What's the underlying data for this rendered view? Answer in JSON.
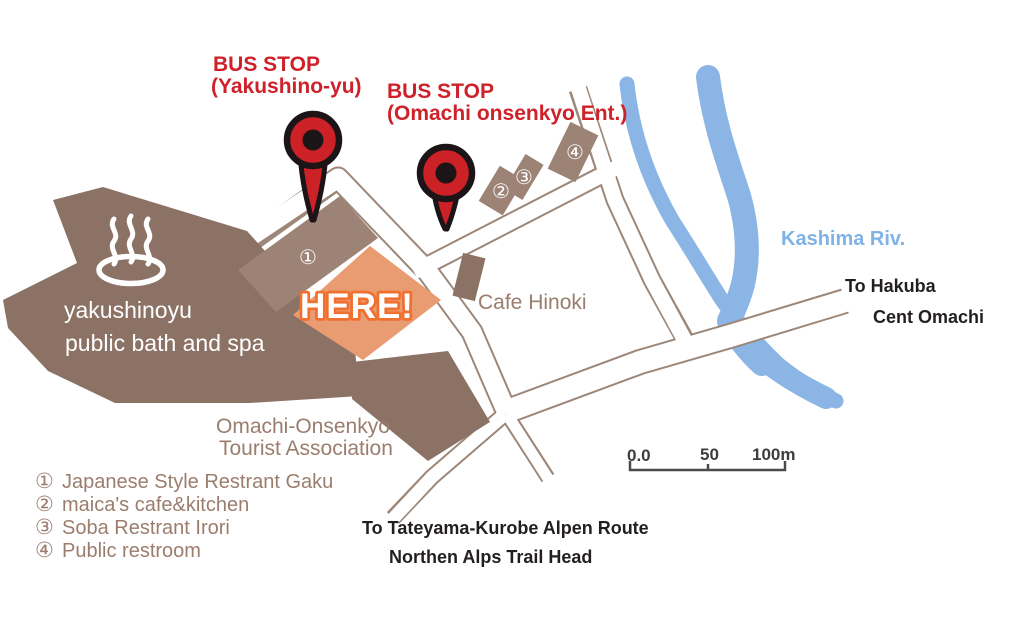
{
  "colors": {
    "building_dark": "#8c7265",
    "building_light": "#9c8376",
    "here_fill": "#e99b72",
    "here_outline": "#f07030",
    "pin_red": "#cb2127",
    "pin_black": "#1c1417",
    "river_blue": "#8ab5e4",
    "river_label_blue": "#7fb2e5",
    "red_label": "#cf2129",
    "brown_label": "#9b7d6d",
    "road_edge": "#9c8779",
    "black_label": "#231f20"
  },
  "bus_stops": [
    {
      "line1": "BUS STOP",
      "line2": "(Yakushino-yu)"
    },
    {
      "line1": "BUS STOP",
      "line2": "(Omachi onsenkyo Ent.)"
    }
  ],
  "spa": {
    "line1": "yakushinoyu",
    "line2": "public bath and spa"
  },
  "here_label": "HERE!",
  "tourist_association": {
    "line1": "Omachi-Onsenkyo",
    "line2": "Tourist Association"
  },
  "cafe_label": "Cafe Hinoki",
  "river_label": "Kashima Riv.",
  "directions": {
    "hakuba": "To Hakuba",
    "cent_omachi": "Cent Omachi",
    "route_line1": "To Tateyama-Kurobe Alpen Route",
    "route_line2": "Northen Alps Trail Head"
  },
  "map_markers": {
    "m1": "①",
    "m2": "②",
    "m3": "③",
    "m4": "④"
  },
  "legend": {
    "items": [
      {
        "num": "①",
        "label": "Japanese Style Restrant Gaku"
      },
      {
        "num": "②",
        "label": "maica's cafe&kitchen"
      },
      {
        "num": "③",
        "label": "Soba Restrant Irori"
      },
      {
        "num": "④",
        "label": "Public restroom"
      }
    ]
  },
  "scale_bar": {
    "zero": "0.0",
    "mid": "50",
    "end": "100m"
  }
}
